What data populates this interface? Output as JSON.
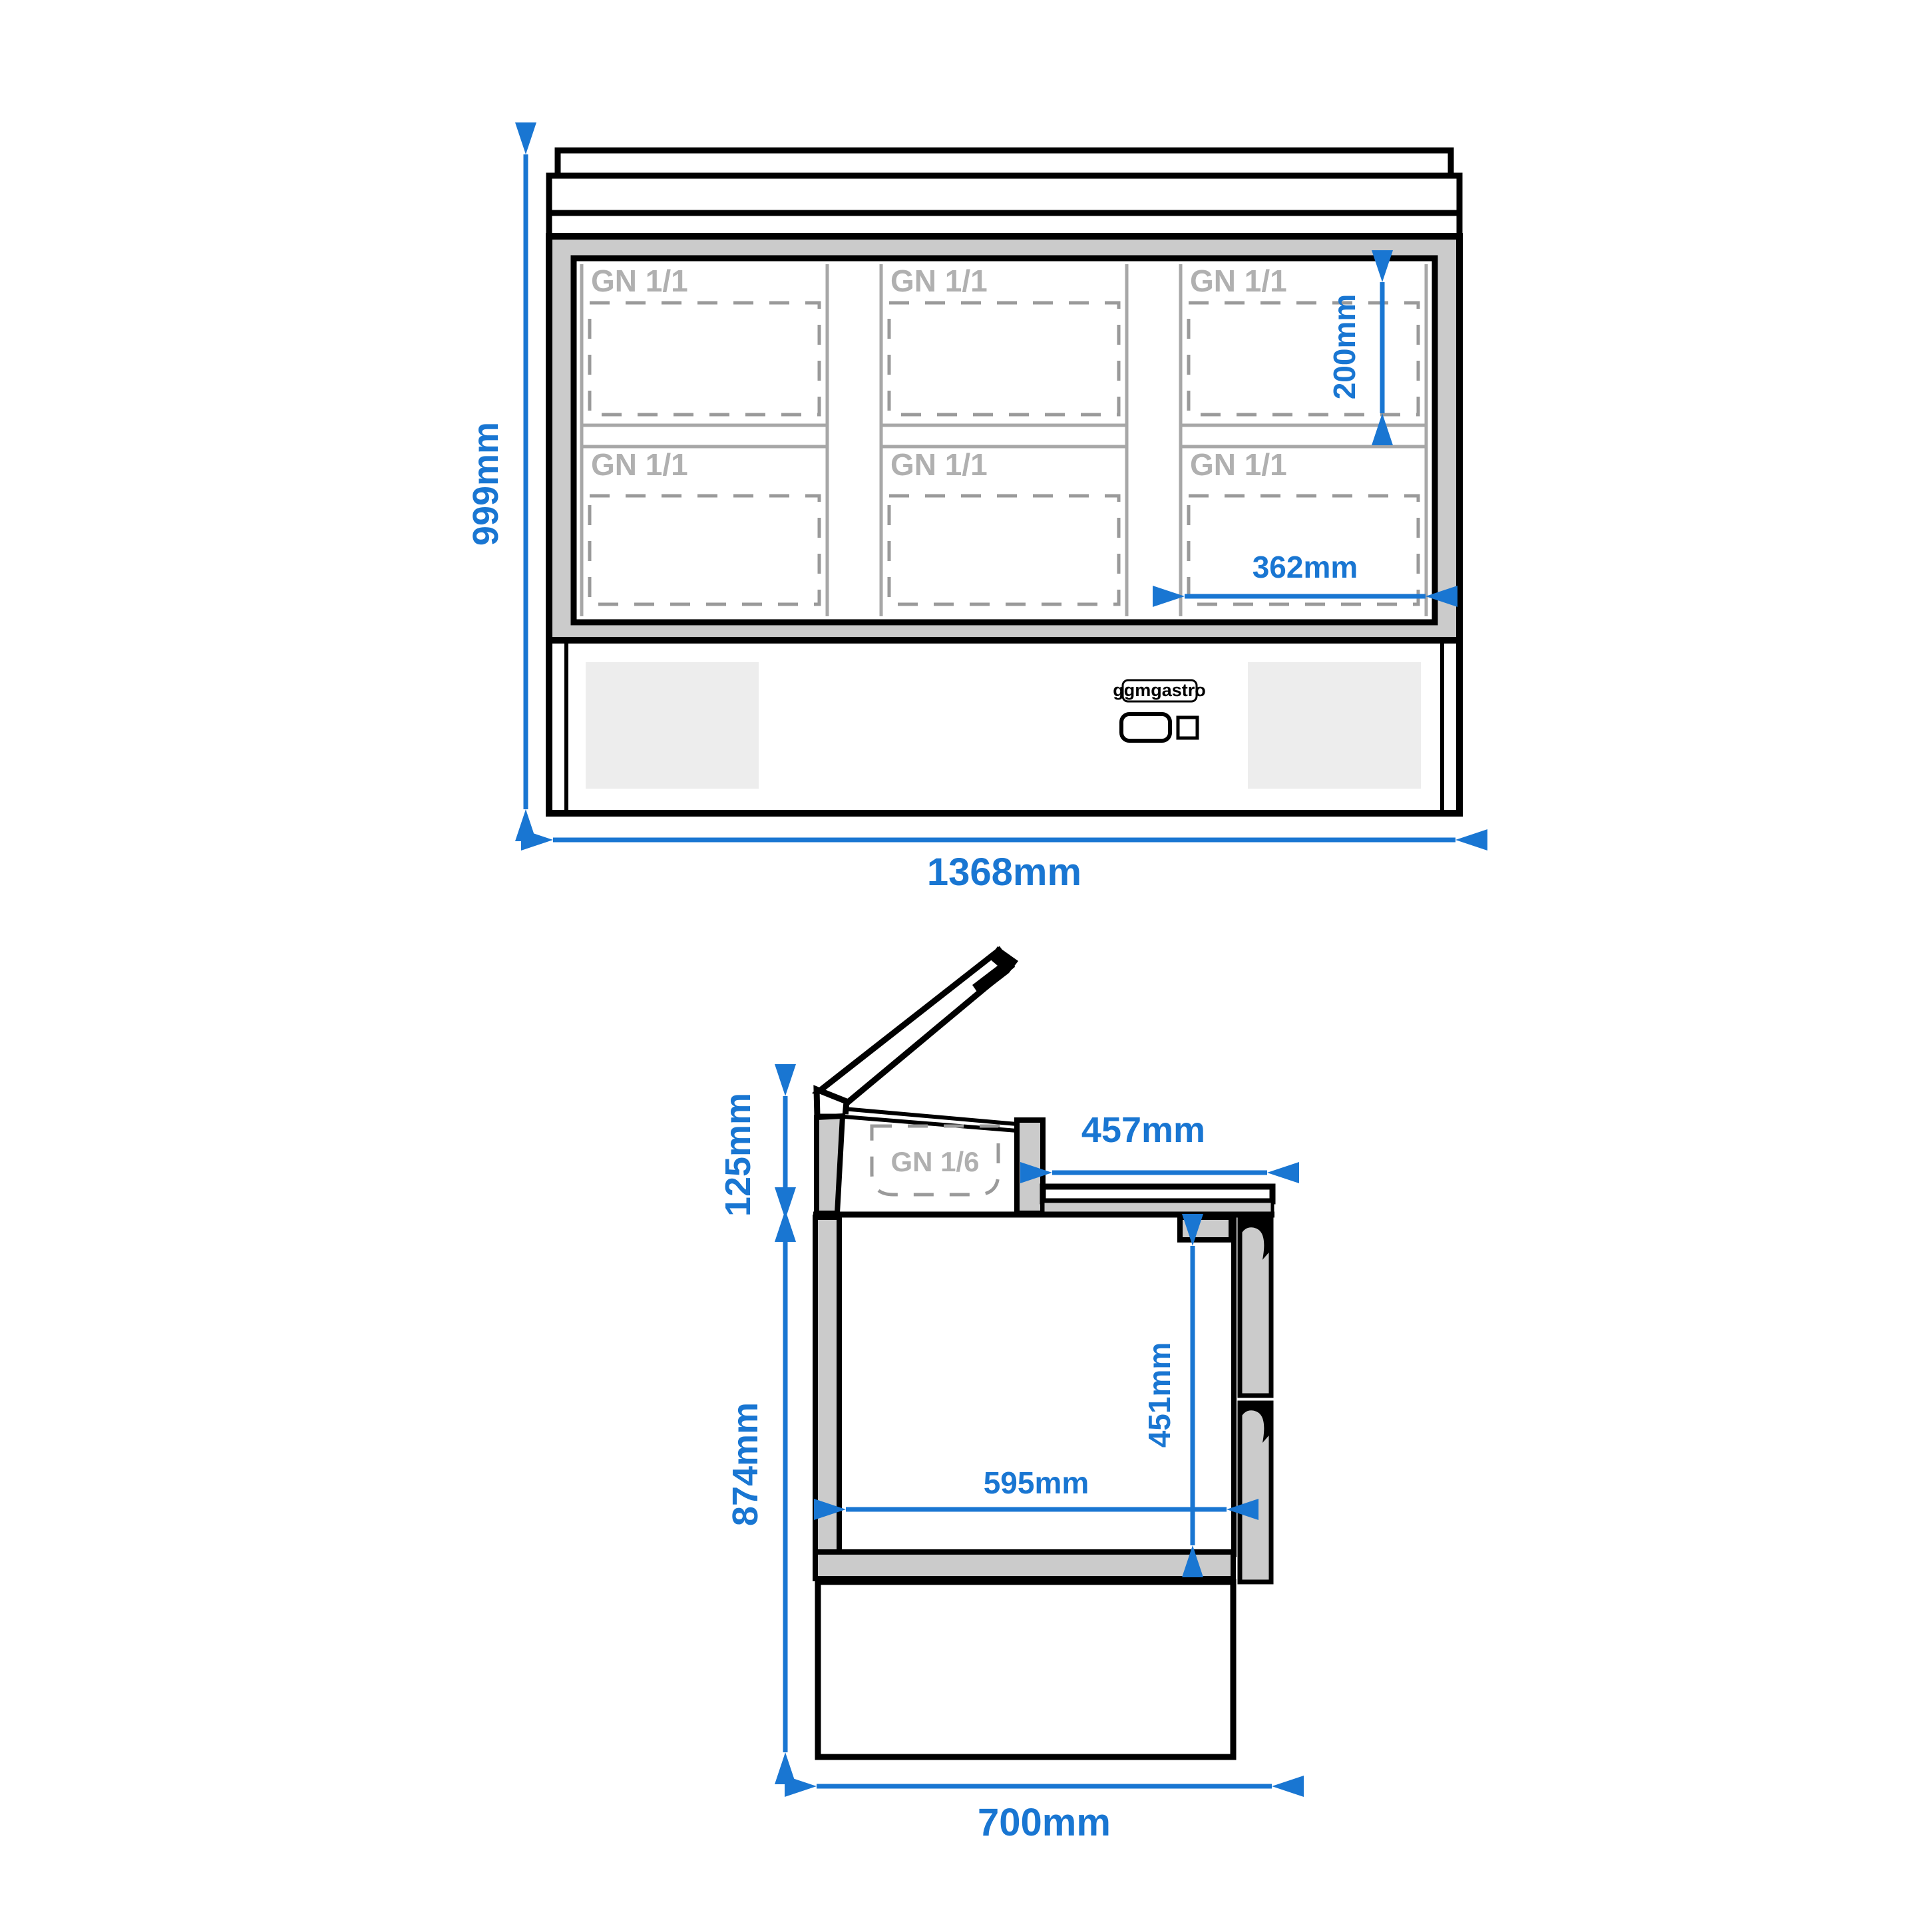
{
  "colors": {
    "accent_blue": "#1976D2"
  },
  "front_view": {
    "dims": {
      "overall_height": "999mm",
      "overall_width": "1368mm",
      "pan_depth": "200mm",
      "pan_width": "362mm"
    },
    "pan_label": "GN 1/1",
    "brand_badge": "ggmgastro"
  },
  "side_view": {
    "dims": {
      "lid_height": "125mm",
      "body_height": "874mm",
      "counter_depth": "457mm",
      "interior_height": "451mm",
      "interior_depth": "595mm",
      "overall_depth": "700mm"
    },
    "pan_label": "GN 1/6"
  }
}
